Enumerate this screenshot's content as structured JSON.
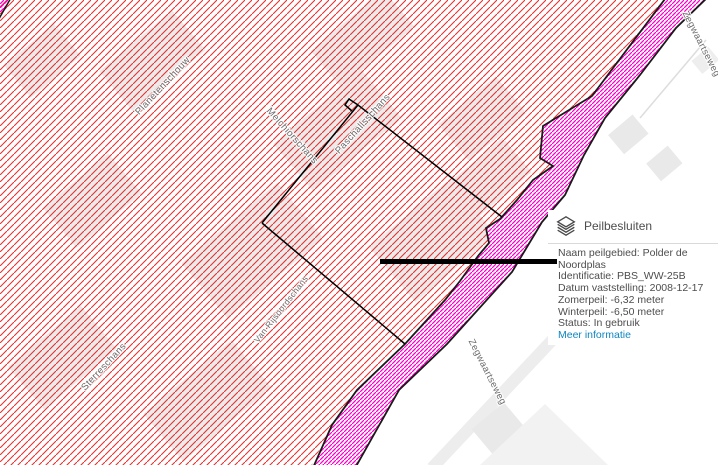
{
  "map": {
    "street_labels": [
      {
        "text": "Planetenschouw"
      },
      {
        "text": "Melchiorschans"
      },
      {
        "text": "Paschalisschans"
      },
      {
        "text": "Van Rijsoordschans"
      },
      {
        "text": "Sterreschans"
      },
      {
        "text": "Zegwaartseweg"
      },
      {
        "text": "Zegwaartseweg"
      }
    ],
    "colors": {
      "peilgebied_hatch": "#e8312e",
      "corridor_hatch": "#ff00cc",
      "boundary": "#000000",
      "label_gray": "#6b6b6b"
    }
  },
  "popup": {
    "icon": "layers-icon",
    "title": "Peilbesluiten",
    "fields": [
      {
        "label": "Naam peilgebied",
        "value": "Polder de Noordplas"
      },
      {
        "label": "Identificatie",
        "value": "PBS_WW-25B"
      },
      {
        "label": "Datum vaststelling",
        "value": "2008-12-17"
      },
      {
        "label": "Zomerpeil",
        "value": "-6,32 meter"
      },
      {
        "label": "Winterpeil",
        "value": "-6,50 meter"
      },
      {
        "label": "Status",
        "value": "In gebruik"
      }
    ],
    "link": {
      "label": "Meer informatie",
      "color": "#0d85c0"
    }
  }
}
